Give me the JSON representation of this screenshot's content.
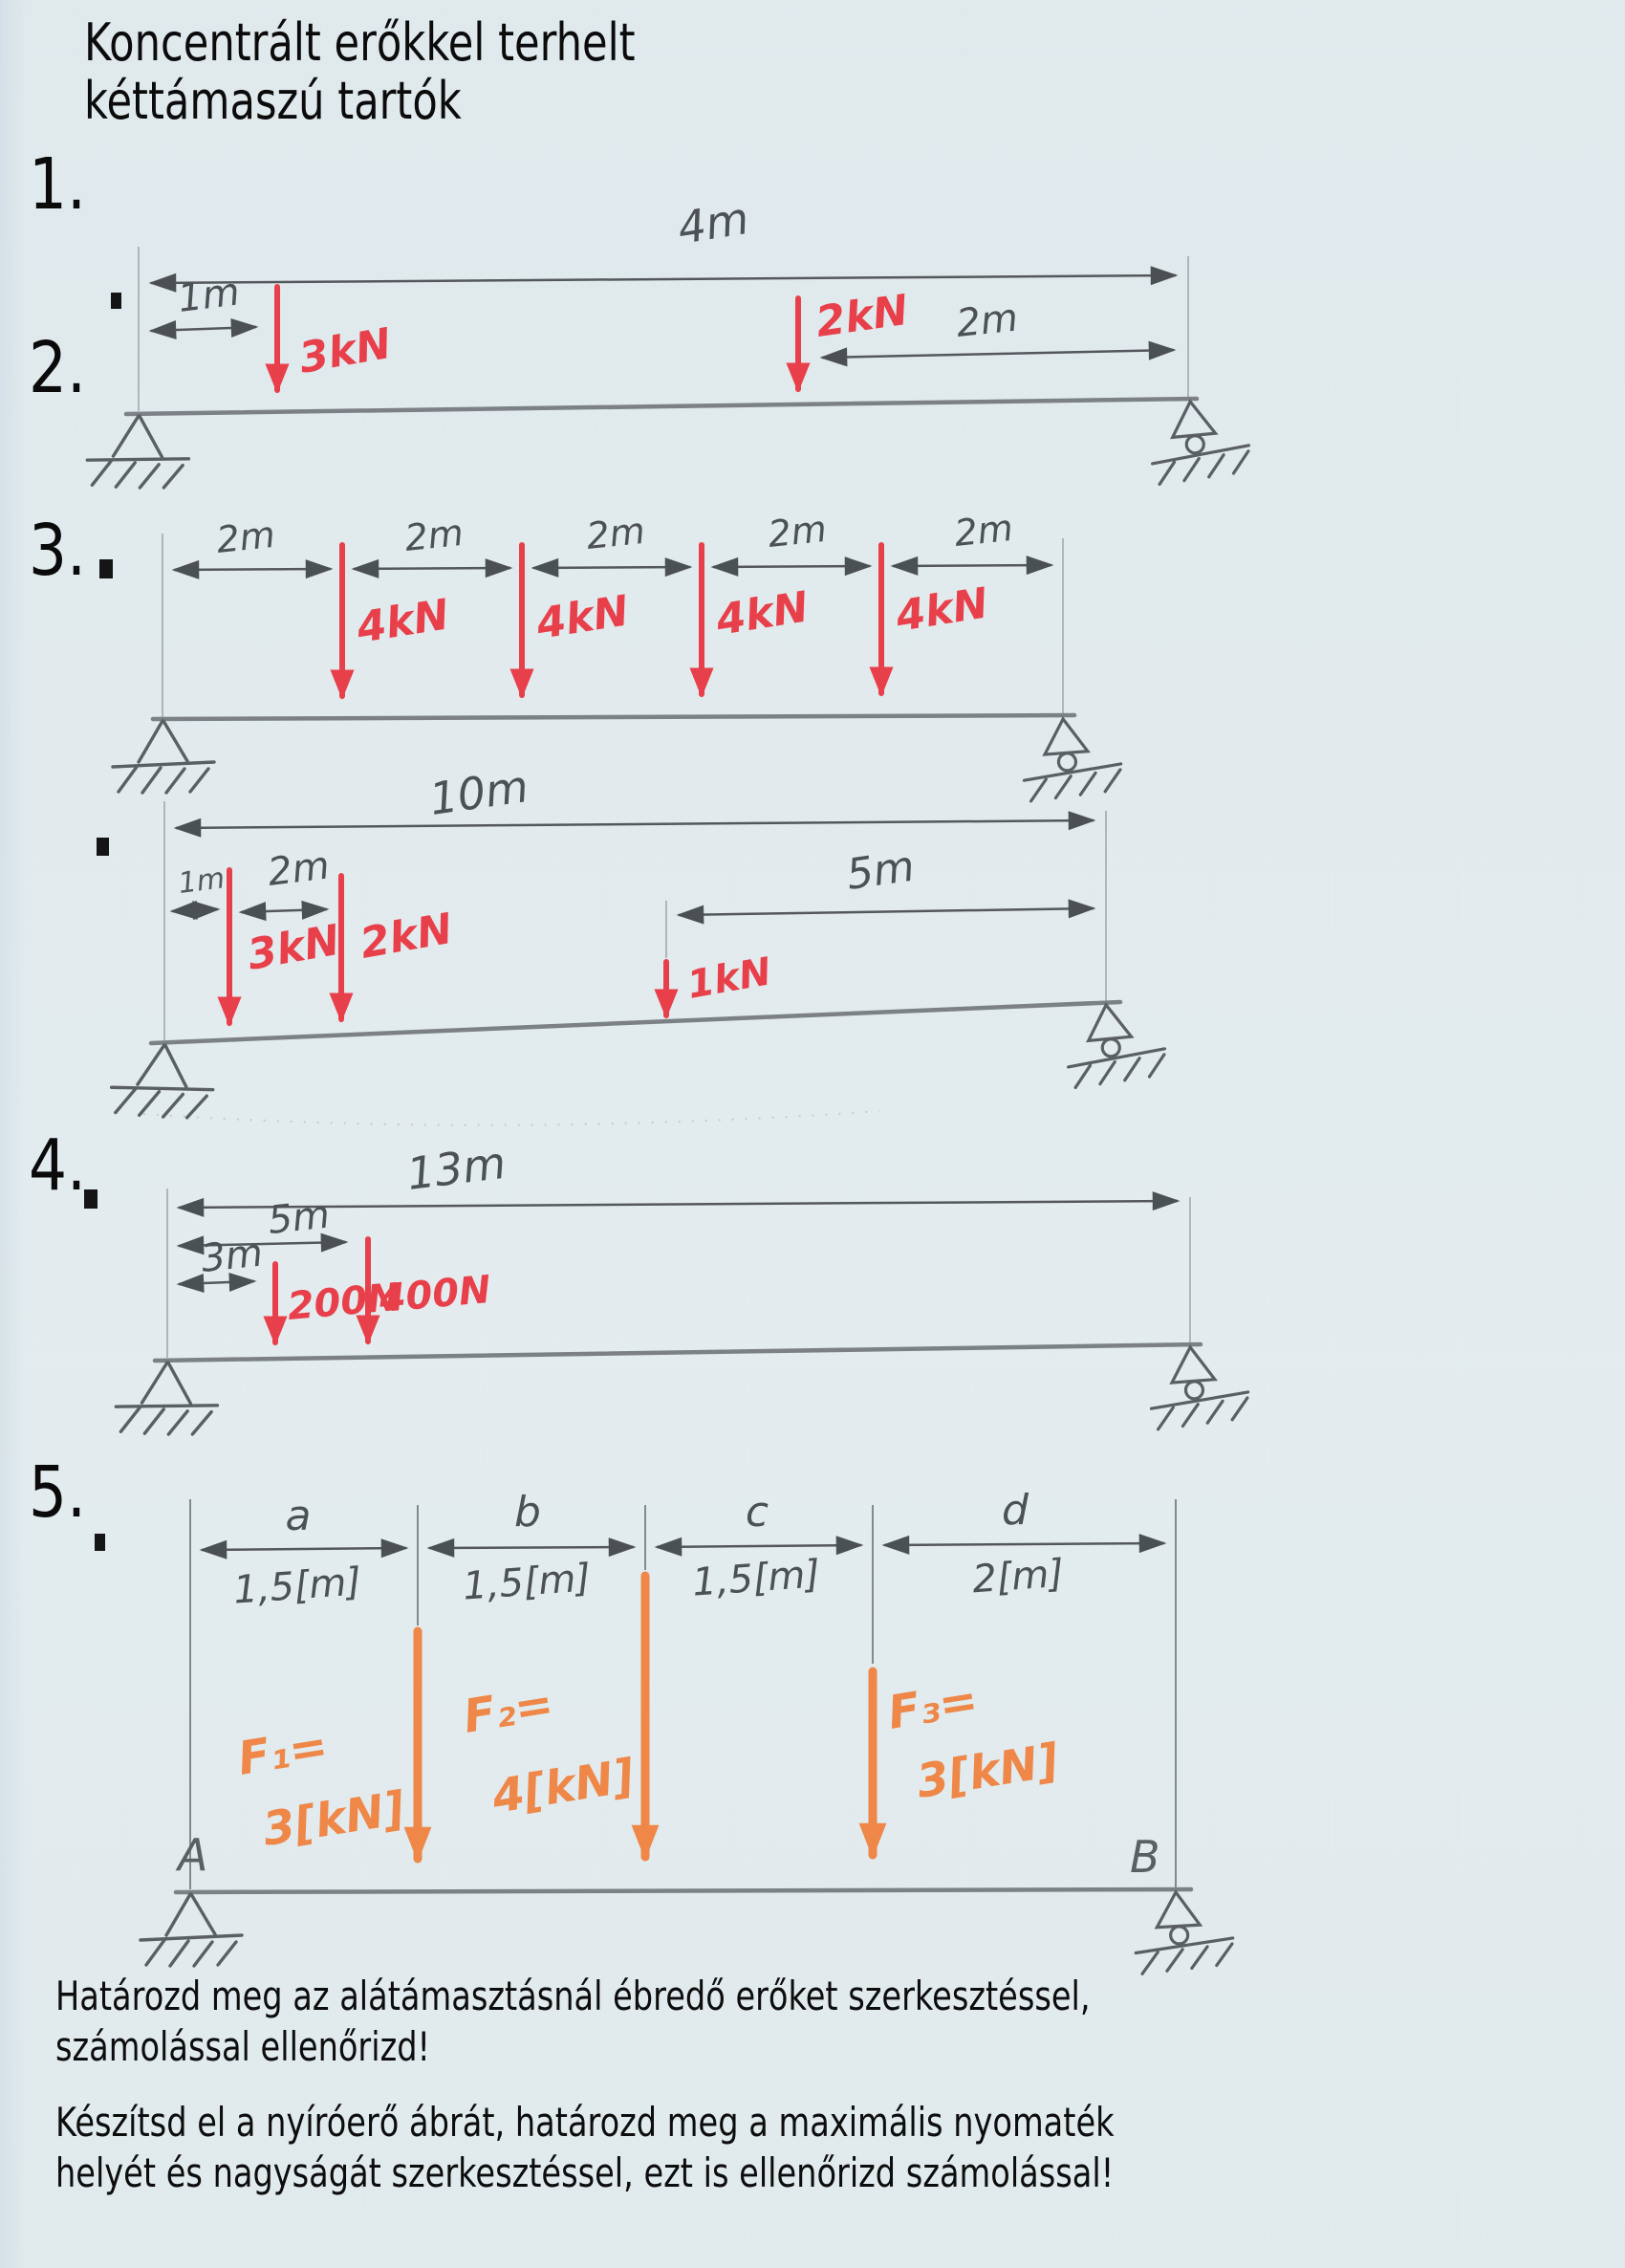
{
  "title": {
    "line1": "Koncentrált erőkkel terhelt",
    "line2": "kéttámaszú tartók"
  },
  "colors": {
    "pencil": "#54585c",
    "beam": "#7b8185",
    "red_marker": "#e8404b",
    "orange_marker": "#ee8747",
    "print_ink": "#0b0b0b"
  },
  "beams": [
    {
      "number": "1.",
      "total": "4m",
      "dims": [
        "1m",
        "2m"
      ],
      "forces": [
        "3kN",
        "2kN"
      ],
      "supports": [
        "pinned-support",
        "roller-support"
      ]
    },
    {
      "number": "2.",
      "dims": [
        "2m",
        "2m",
        "2m",
        "2m",
        "2m"
      ],
      "forces": [
        "4kN",
        "4kN",
        "4kN",
        "4kN"
      ],
      "supports": [
        "pinned-support",
        "roller-support"
      ]
    },
    {
      "number": "3.",
      "total": "10m",
      "dims": [
        "1m",
        "2m",
        "5m"
      ],
      "forces": [
        "3kN",
        "2kN",
        "1kN"
      ],
      "supports": [
        "pinned-support",
        "roller-support"
      ]
    },
    {
      "number": "4.",
      "total": "13m",
      "dims": [
        "5m",
        "3m"
      ],
      "forces": [
        "200N",
        "400N"
      ],
      "supports": [
        "pinned-support",
        "roller-support"
      ]
    },
    {
      "number": "5.",
      "letters": [
        "a",
        "b",
        "c",
        "d"
      ],
      "span_dims": [
        "1,5[m]",
        "1,5[m]",
        "1,5[m]",
        "2[m]"
      ],
      "force_names": [
        "F₁=",
        "F₂=",
        "F₃="
      ],
      "force_values": [
        "3[kN]",
        "4[kN]",
        "3[kN]"
      ],
      "support_labels": [
        "A",
        "B"
      ],
      "supports": [
        "pinned-support",
        "roller-support"
      ]
    }
  ],
  "instructions": {
    "para1_line1": "Határozd meg az alátámasztásnál ébredő erőket szerkesztéssel,",
    "para1_line2": "számolással ellenőrizd!",
    "para2_line1": "Készítsd el a nyíróerő ábrát, határozd meg a maximális nyomaték",
    "para2_line2": "helyét és nagyságát szerkesztéssel, ezt is ellenőrizd számolással!"
  }
}
